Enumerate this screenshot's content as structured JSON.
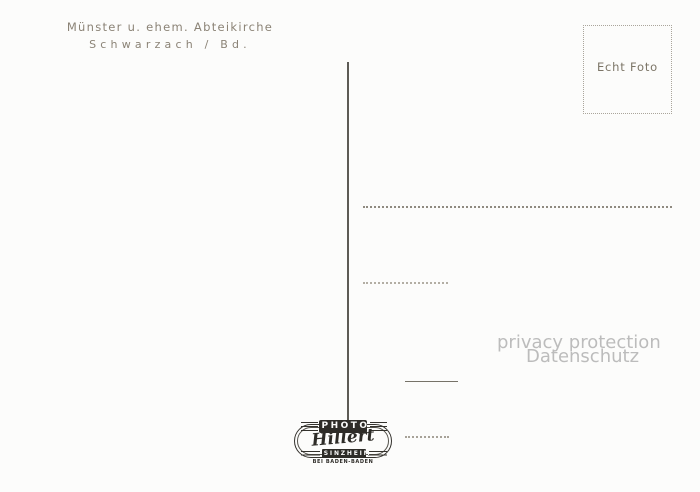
{
  "postcard": {
    "caption": {
      "line1": "Münster u. ehem. Abteikirche",
      "line2": "Schwarzach / Bd."
    },
    "stamp_box": {
      "label": "Echt Foto"
    },
    "watermark": {
      "line1": "privacy protection",
      "line2": "Datenschutz"
    },
    "publisher_logo": {
      "header": "PHOTO",
      "name": "Hillert",
      "city": "SINZHEIM",
      "subtitle": "BEI BADEN-BADEN"
    },
    "colors": {
      "background": "#fcfcfb",
      "caption_text": "#8b8376",
      "divider_line": "#5d5b55",
      "dotted_lines": "#8f8a80",
      "watermark_text": "#bcbcbc",
      "logo_ink": "#2e2c28"
    }
  }
}
